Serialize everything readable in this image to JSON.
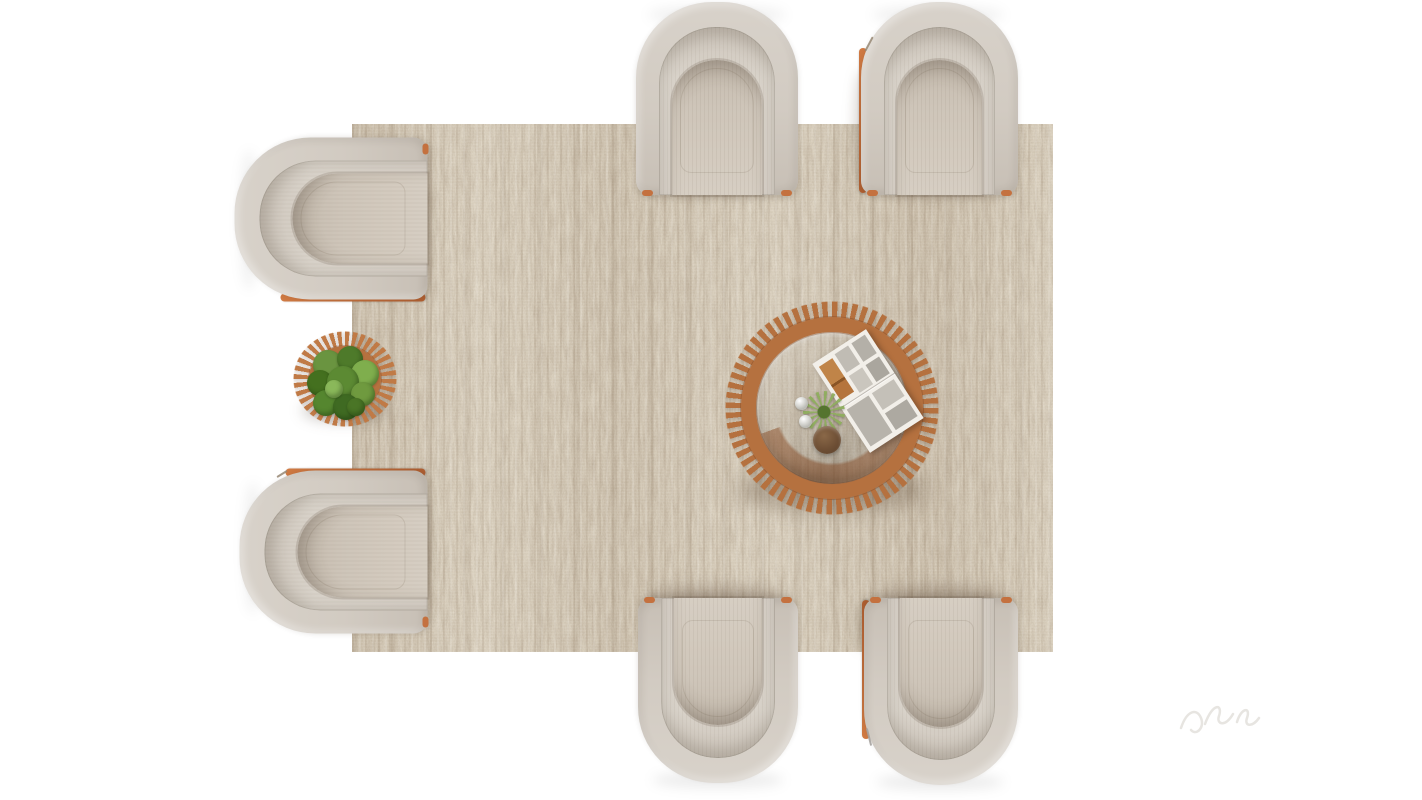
{
  "meta": {
    "title": "Top-down 3D render of a living room seating arrangement",
    "render_type": "furniture top view",
    "canvas": {
      "width": 1422,
      "height": 800
    }
  },
  "palette": {
    "floor_white": "#ffffff",
    "rug_base": "#b3a694",
    "rug_light": "#d8d1c3",
    "rug_dark": "#77624a",
    "chair_shell": "#d2cbc2",
    "chair_inner": "#d8d2c9",
    "chair_seat": "#cec5b9",
    "trim_orange": "#c4713f",
    "table_wood": "#b5713f",
    "table_wood_dark": "#8a4f28",
    "plant_green": "#5c8a33",
    "plant_green_dark": "#3f6a22",
    "pot_brown": "#6e4f35",
    "magazine_page": "#f2efe9"
  },
  "scene": {
    "floor": {
      "label": "plain white floor"
    },
    "rug": {
      "label": "large rectangular mottled beige-brown jute rug",
      "x": 352,
      "y": 124,
      "width": 701,
      "height": 528,
      "texture": "vertical boucle striations with brown flecks"
    },
    "chairs": [
      {
        "id": "chair-top-center",
        "label": "beige tub armchair, top view, opening facing down toward rug",
        "facing": "down",
        "x": 636,
        "y": 2,
        "width": 162,
        "height": 193,
        "accents": [
          "orange front tips"
        ]
      },
      {
        "id": "chair-top-right",
        "label": "beige tub armchair with orange leather edge on left side",
        "facing": "down",
        "x": 861,
        "y": 2,
        "width": 157,
        "height": 193,
        "accents": [
          "orange left edge",
          "twig"
        ]
      },
      {
        "id": "chair-left-top",
        "label": "beige tub armchair, opening facing right, orange edge below",
        "facing": "right",
        "x": 235,
        "y": 138,
        "width": 193,
        "height": 162,
        "accents": [
          "orange bottom edge"
        ]
      },
      {
        "id": "chair-left-bottom",
        "label": "beige tub armchair, opening facing right, orange edge above",
        "facing": "right",
        "x": 240,
        "y": 470,
        "width": 188,
        "height": 163,
        "accents": [
          "orange top edge",
          "twig"
        ]
      },
      {
        "id": "chair-bottom-center",
        "label": "beige tub armchair, opening facing up toward rug",
        "facing": "up",
        "x": 638,
        "y": 598,
        "width": 160,
        "height": 185,
        "accents": [
          "orange front tips"
        ]
      },
      {
        "id": "chair-bottom-right",
        "label": "beige tub armchair with orange leather edge on left side",
        "facing": "up",
        "x": 864,
        "y": 598,
        "width": 154,
        "height": 187,
        "accents": [
          "orange left edge",
          "twig"
        ]
      }
    ],
    "coffee_table": {
      "label": "round terracotta coffee table with radial wood slats and glass top",
      "center_x": 832,
      "center_y": 408,
      "outer_diameter": 214,
      "slat_count": 64,
      "items": [
        "open magazine with grayscale photo spread and one warm-toned photo",
        "small spiky green plant",
        "round clay pot",
        "two clear glass spheres"
      ]
    },
    "side_table": {
      "label": "small round slatted planter side table between left chairs",
      "center_x": 345,
      "center_y": 379,
      "outer_width": 104,
      "outer_height": 96,
      "items": [
        "leafy green plant"
      ]
    },
    "watermark": {
      "label": "faint light-gray render watermark squiggle near bottom right"
    }
  }
}
